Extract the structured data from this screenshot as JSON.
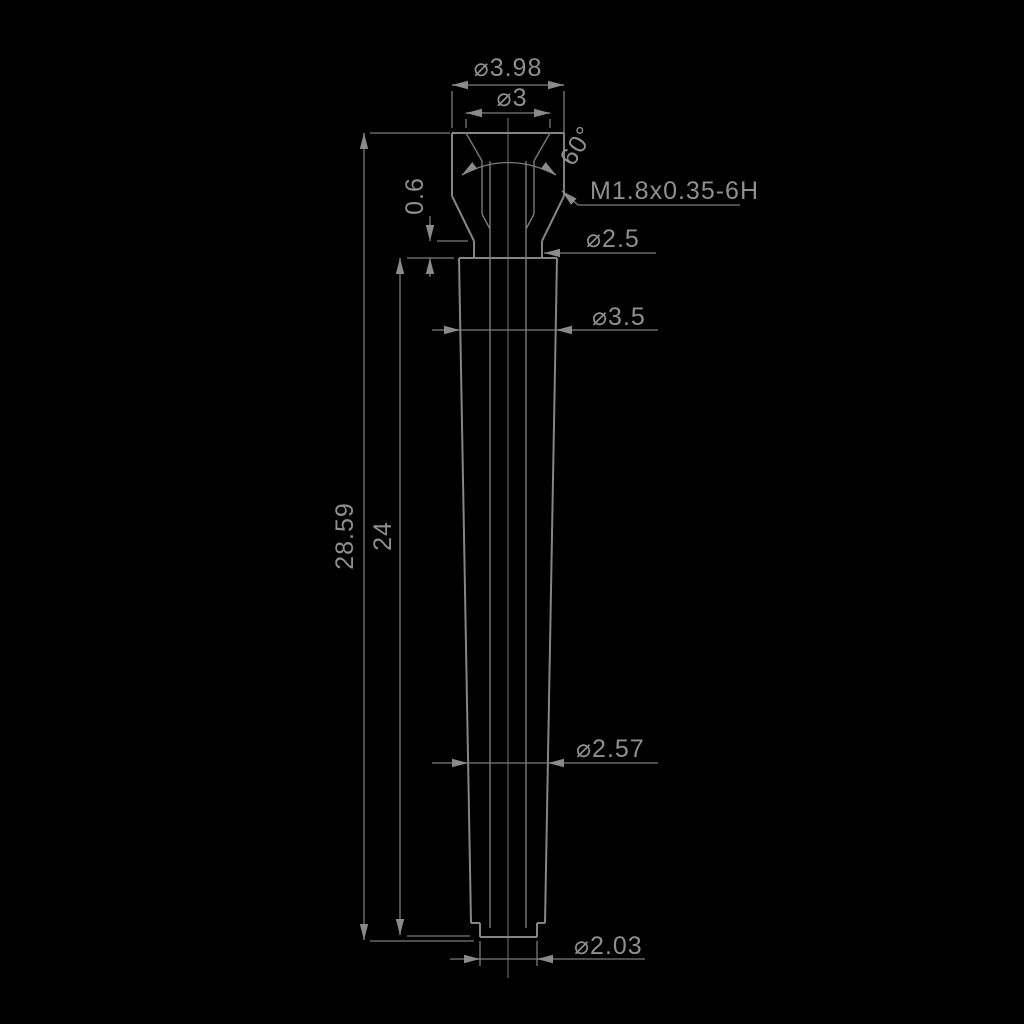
{
  "drawing": {
    "type": "engineering-part-drawing",
    "background_color": "#000000",
    "line_color": "#858585",
    "dimension_line_color": "#7b7b7b",
    "text_color": "#8f8f8f",
    "labels": {
      "top_outer_diameter": "⌀3.98",
      "countersink_diameter": "⌀3",
      "countersink_angle": "60°",
      "thread_spec": "M1.8x0.35-6H",
      "collar_height": "0.6",
      "neck_diameter": "⌀2.5",
      "body_major_diameter": "⌀3.5",
      "overall_length": "28.59",
      "body_length": "24",
      "body_minor_diameter": "⌀2.57",
      "tip_diameter": "⌀2.03"
    }
  }
}
